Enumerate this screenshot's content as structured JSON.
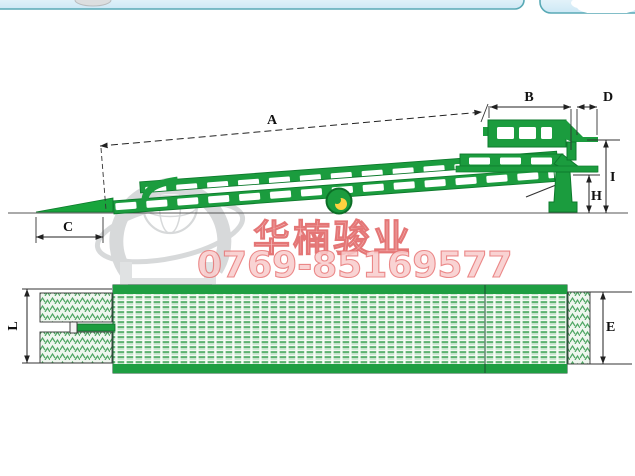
{
  "watermark": {
    "company_name": "华楠骏业",
    "phone": "0769-85169577"
  },
  "diagram": {
    "type": "technical-drawing",
    "subject": "mobile-yard-loading-ramp",
    "views": [
      "side-elevation",
      "top-plan"
    ],
    "labels": {
      "A": "A",
      "B": "B",
      "C": "C",
      "D": "D",
      "E": "E",
      "H": "H",
      "I": "I",
      "L": "L"
    },
    "colors": {
      "ramp_green": "#1b9c3e",
      "deck_strip_green": "#1e9e42",
      "wheel_hub_yellow": "#ffd23f",
      "dimension_line": "#222222",
      "watermark_red": "#e05f5f",
      "watermark_grey": "#b0b4b7",
      "panel_border_teal": "#58a9b5",
      "panel_fill_blue": "#cde8f5"
    }
  }
}
